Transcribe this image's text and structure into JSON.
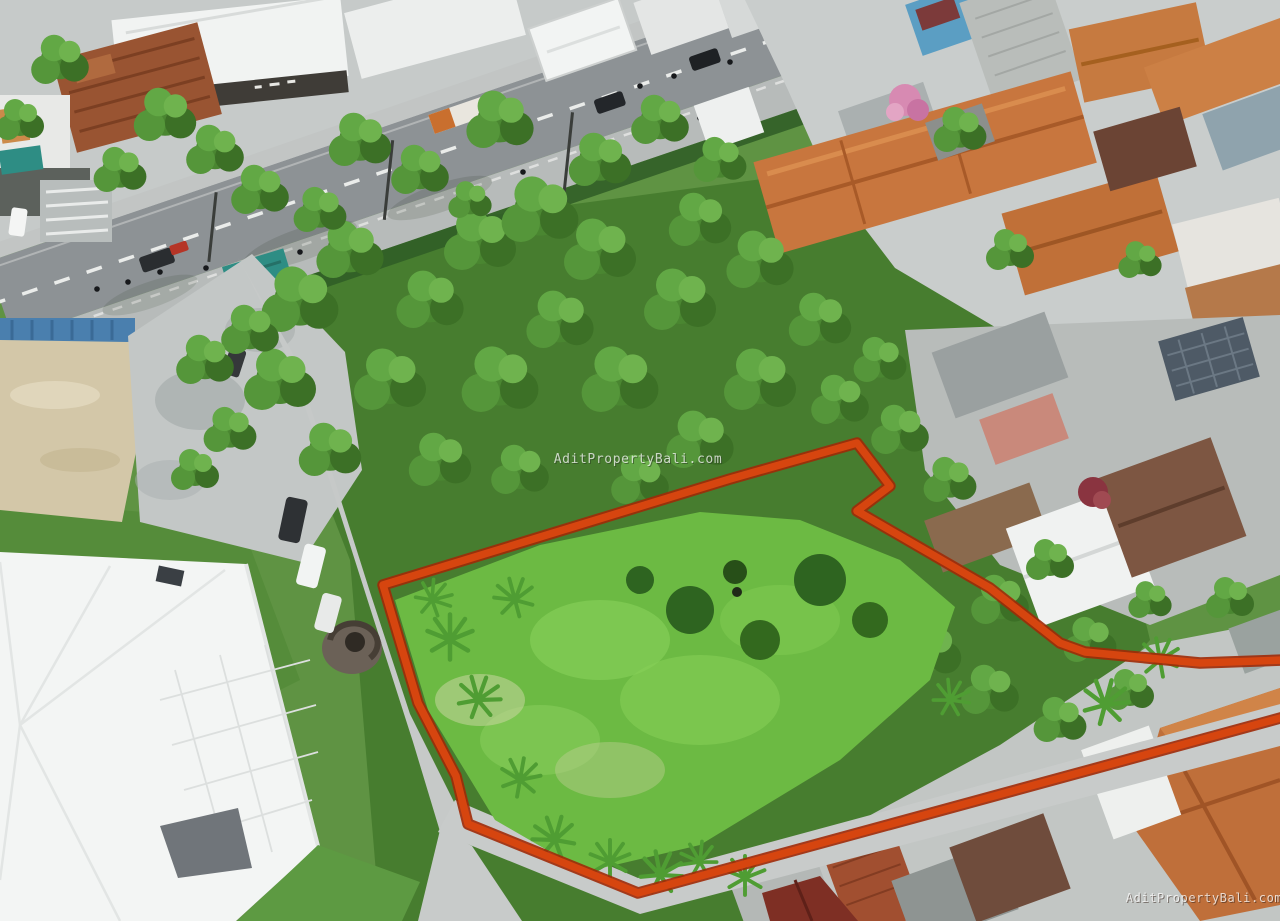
{
  "photo": {
    "alt": "Aerial drone view of a vacant green land plot outlined in red, surrounded by roads, shops and terracotta-roofed houses",
    "width_px": 1280,
    "height_px": 921
  },
  "watermark": {
    "text": "AditPropertyBali.com",
    "color": "#ffffff"
  },
  "land_boundary": {
    "color": "#d6450f",
    "points": "1284,660 1200,663 1085,652 1060,643 990,588 857,511 890,486 857,443 730,479 383,585 418,703 456,776 468,824 638,893 1284,717"
  }
}
